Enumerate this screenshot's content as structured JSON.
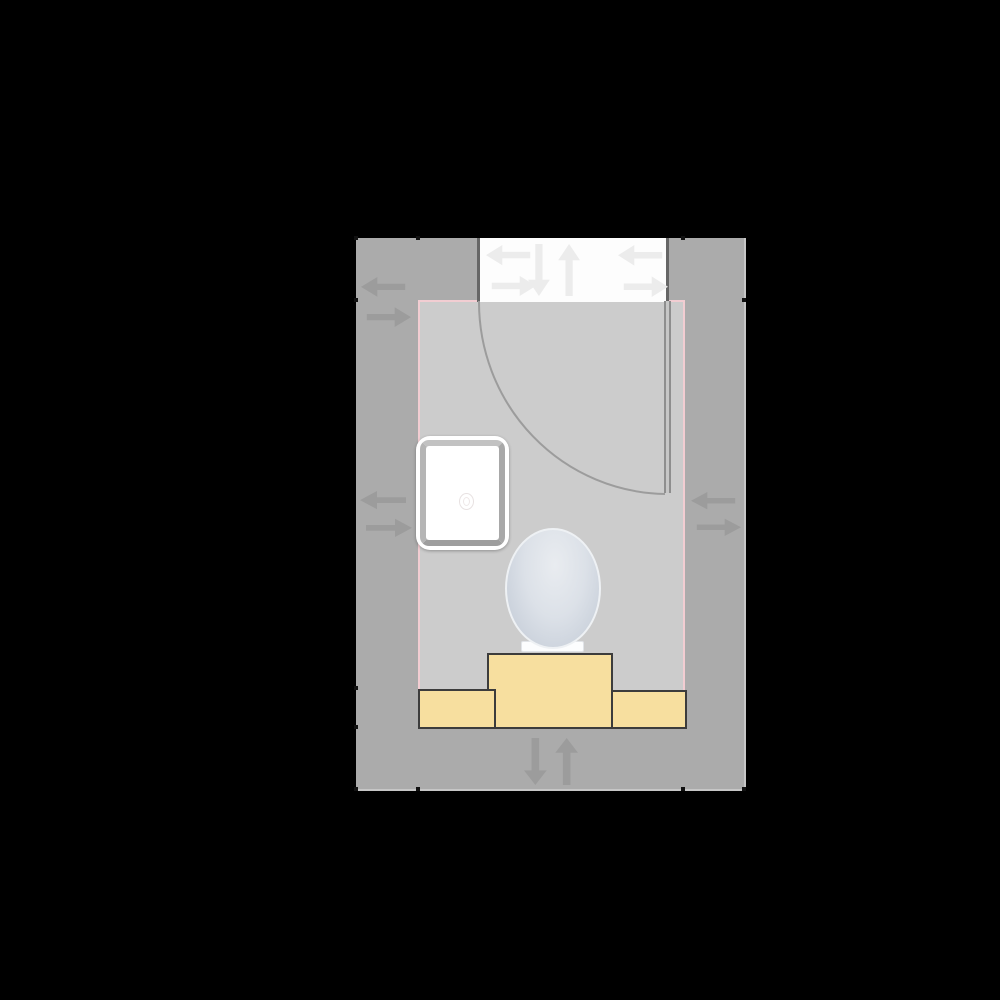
{
  "app": {
    "type": "floor-plan-editor-canvas",
    "view": "2d-top-down"
  },
  "colors": {
    "background": "#000000",
    "wall": "#ababab",
    "wall_edge": "#c6c6c6",
    "floor": "#cccccc",
    "room_outline": "#f2cdd2",
    "door_opening": "#fdfdfd",
    "door_frame": "#666666",
    "door_leaf": "#8e8e8e",
    "door_arc": "#9c9c9c",
    "arrow_on_wall": "#9c9c9c",
    "arrow_on_white": "#ececec",
    "cabinet_fill": "#f7df9f",
    "cabinet_border": "#3c3c3c",
    "fixture_white": "#ffffff",
    "fixture_rim": "#aeaeae",
    "toilet_center": "#e9ecf0",
    "toilet_edge": "#c6cdd8",
    "tick": "#111111"
  },
  "room": {
    "shape": "rectangular",
    "outline_style": "pink interior trim line",
    "walls": [
      "top",
      "right",
      "bottom",
      "left"
    ]
  },
  "door": {
    "location": "top wall",
    "hinge_side": "right",
    "swing": "inward quarter-circle arc",
    "state": "open"
  },
  "fixtures": [
    {
      "id": "shower-tray",
      "kind": "shower tray with drain",
      "color": "white"
    },
    {
      "id": "toilet",
      "kind": "toilet (top view, oval lid)",
      "color": "light blue-gray"
    },
    {
      "id": "cabinet-center",
      "kind": "cabinet block",
      "color": "yellow"
    },
    {
      "id": "cabinet-left",
      "kind": "low cabinet block",
      "color": "yellow"
    },
    {
      "id": "cabinet-right",
      "kind": "low cabinet block",
      "color": "yellow"
    }
  ],
  "controls": [
    {
      "id": "wall-left-upper-flip",
      "icon": "swap-horizontal-icon"
    },
    {
      "id": "wall-left-middle-flip",
      "icon": "swap-horizontal-icon"
    },
    {
      "id": "wall-right-middle-flip",
      "icon": "swap-horizontal-icon"
    },
    {
      "id": "wall-bottom-flip",
      "icon": "swap-vertical-icon"
    },
    {
      "id": "door-flip-left",
      "icon": "swap-horizontal-icon"
    },
    {
      "id": "door-flip-vertical",
      "icon": "swap-vertical-icon"
    },
    {
      "id": "door-flip-right",
      "icon": "swap-horizontal-icon"
    }
  ],
  "markers": {
    "wall_endpoint_ticks": 11
  }
}
